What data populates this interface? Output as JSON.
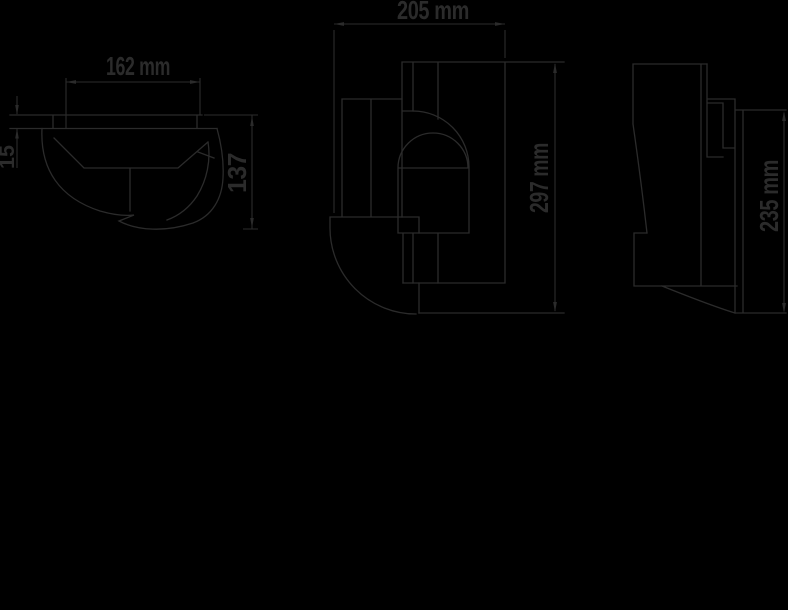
{
  "page": {
    "background_color": "#000000",
    "line_color": "#2b2b2b"
  },
  "drawing": {
    "type": "technical-dimension-drawing",
    "dimensions": {
      "top_view_width": "162 mm",
      "top_view_plate_thickness": "15",
      "top_view_depth": "137",
      "front_view_width": "205 mm",
      "front_view_height": "297 mm",
      "side_view_height": "235 mm"
    }
  }
}
